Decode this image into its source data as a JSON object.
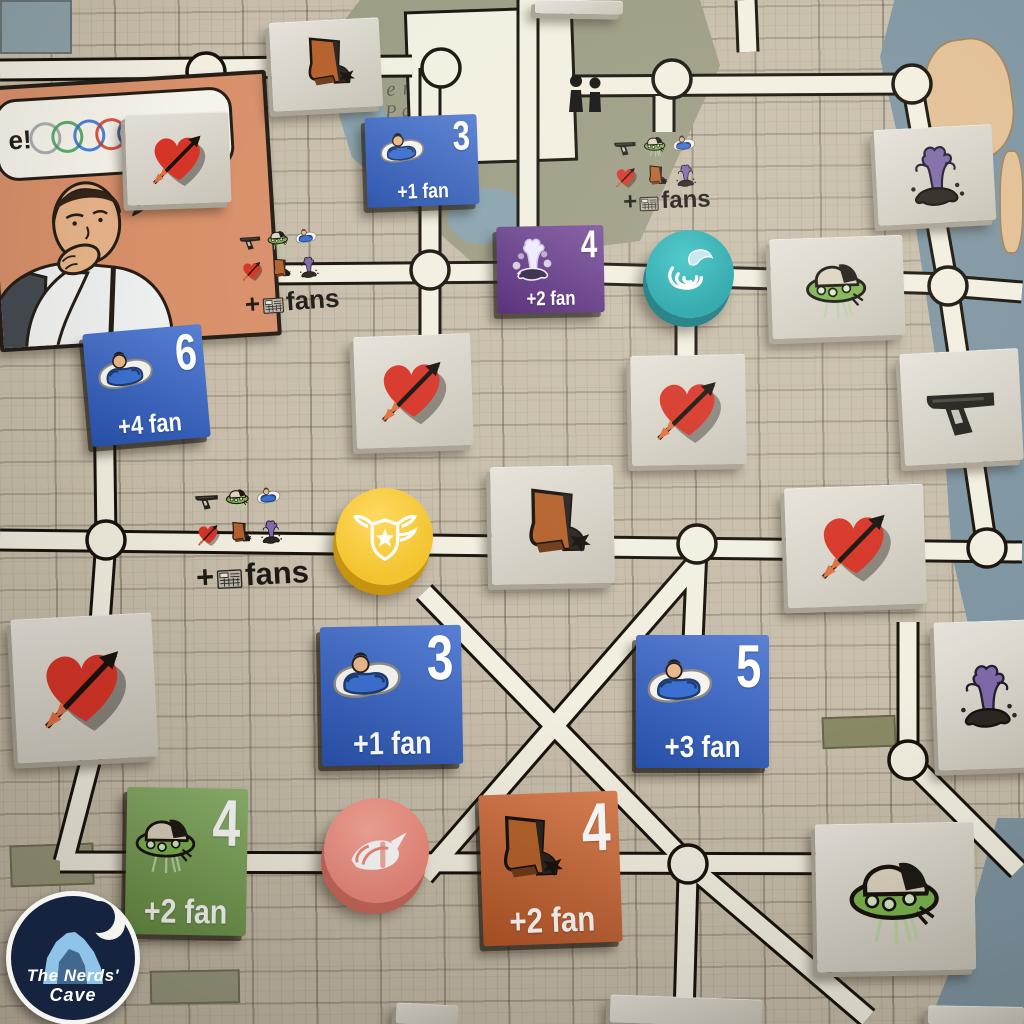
{
  "board": {
    "park_label_line1": "Central",
    "park_label_line2": "Park",
    "colors": {
      "paper": "#c7bdaa",
      "road": "#f2efe1",
      "road_outline": "#17130c",
      "park": "#9c9b83",
      "water": "#7e95a2",
      "sand": "#e2c096",
      "tile_gray": "#d9d5cb",
      "blue": "#2d5ec7",
      "purple": "#5b2a86",
      "green": "#74a44c",
      "orange": "#d2622c"
    }
  },
  "comic": {
    "bubble_text": "e!",
    "ring_colors": [
      "#9aa0a6",
      "#3f9e57",
      "#2e6fd0",
      "#d03a2a",
      "#274b9f"
    ]
  },
  "fans_tile": {
    "plus": "+",
    "label": "fans",
    "icons": [
      "gun",
      "ufo",
      "hero",
      "heart",
      "boot",
      "zombie"
    ]
  },
  "watermark": {
    "line1": "The Nerds'",
    "line2": "Cave"
  },
  "tiles": [
    {
      "id": "boot-tile-top-left",
      "kind": "icon",
      "icon": "boot",
      "x": 271,
      "y": 20,
      "w": 110,
      "h": 88,
      "rot": -3
    },
    {
      "id": "heart-tile-top-left",
      "kind": "icon",
      "icon": "heart",
      "x": 126,
      "y": 113,
      "w": 104,
      "h": 90,
      "rot": -2
    },
    {
      "id": "blue-reward-3-top",
      "kind": "reward",
      "icon": "hero",
      "color": "#2d5ec7",
      "number": "3",
      "fan": "+1 fan",
      "x": 366,
      "y": 116,
      "w": 112,
      "h": 90,
      "rot": -2
    },
    {
      "id": "fans-tile-top",
      "kind": "fans",
      "x": 606,
      "y": 127,
      "w": 120,
      "h": 92,
      "rot": -2
    },
    {
      "id": "zombie-tile-top-right",
      "kind": "icon",
      "icon": "zombie",
      "x": 876,
      "y": 127,
      "w": 118,
      "h": 95,
      "rot": -3
    },
    {
      "id": "fans-tile-upper-left",
      "kind": "fans",
      "x": 233,
      "y": 221,
      "w": 114,
      "h": 100,
      "rot": -4
    },
    {
      "id": "purple-reward-4",
      "kind": "reward",
      "icon": "zombieWhite",
      "color": "#5b2a86",
      "number": "4",
      "fan": "+2 fan",
      "x": 497,
      "y": 226,
      "w": 107,
      "h": 87,
      "rot": -1
    },
    {
      "id": "ufo-tile-right",
      "kind": "icon",
      "icon": "ufo",
      "x": 771,
      "y": 237,
      "w": 133,
      "h": 99,
      "rot": -2
    },
    {
      "id": "blue-reward-6",
      "kind": "reward",
      "icon": "hero",
      "color": "#2d5ec7",
      "number": "6",
      "fan": "+4 fan",
      "x": 87,
      "y": 329,
      "w": 119,
      "h": 113,
      "rot": -5
    },
    {
      "id": "heart-tile-mid-left",
      "kind": "icon",
      "icon": "heart",
      "x": 355,
      "y": 335,
      "w": 117,
      "h": 111,
      "rot": -2
    },
    {
      "id": "heart-tile-mid-right",
      "kind": "icon",
      "icon": "heart",
      "x": 631,
      "y": 355,
      "w": 115,
      "h": 109,
      "rot": -1
    },
    {
      "id": "gun-tile-right",
      "kind": "icon",
      "icon": "gun",
      "x": 902,
      "y": 351,
      "w": 119,
      "h": 111,
      "rot": -3
    },
    {
      "id": "fans-tile-mid",
      "kind": "fans",
      "x": 187,
      "y": 477,
      "w": 127,
      "h": 121,
      "rot": -3
    },
    {
      "id": "boot-tile-center",
      "kind": "icon",
      "icon": "boot",
      "x": 491,
      "y": 466,
      "w": 123,
      "h": 117,
      "rot": -1
    },
    {
      "id": "heart-tile-right",
      "kind": "icon",
      "icon": "heart",
      "x": 786,
      "y": 486,
      "w": 139,
      "h": 119,
      "rot": -2
    },
    {
      "id": "heart-tile-left",
      "kind": "icon",
      "icon": "heart",
      "x": 14,
      "y": 616,
      "w": 141,
      "h": 143,
      "rot": -3
    },
    {
      "id": "blue-reward-3-mid",
      "kind": "reward",
      "icon": "hero",
      "color": "#2d5ec7",
      "number": "3",
      "fan": "+1 fan",
      "x": 321,
      "y": 626,
      "w": 141,
      "h": 139,
      "rot": -1
    },
    {
      "id": "blue-reward-5",
      "kind": "reward",
      "icon": "hero",
      "color": "#2d5ec7",
      "number": "5",
      "fan": "+3 fan",
      "x": 636,
      "y": 635,
      "w": 133,
      "h": 133,
      "rot": 0
    },
    {
      "id": "zombie-tile-right",
      "kind": "icon",
      "icon": "zombie",
      "x": 936,
      "y": 621,
      "w": 100,
      "h": 147,
      "rot": -2
    },
    {
      "id": "green-reward-4",
      "kind": "reward",
      "icon": "ufo",
      "color": "#74a44c",
      "number": "4",
      "fan": "+2 fan",
      "x": 126,
      "y": 788,
      "w": 121,
      "h": 147,
      "rot": 1
    },
    {
      "id": "orange-reward-4",
      "kind": "reward",
      "icon": "boot",
      "color": "#d2622c",
      "number": "4",
      "fan": "+2 fan",
      "x": 481,
      "y": 793,
      "w": 139,
      "h": 151,
      "rot": -2
    },
    {
      "id": "ufo-tile-bottom-right",
      "kind": "icon",
      "icon": "ufo",
      "x": 816,
      "y": 823,
      "w": 159,
      "h": 147,
      "rot": -1
    },
    {
      "id": "tile-edge-top",
      "kind": "partial",
      "x": 535,
      "y": 0,
      "w": 88,
      "h": 13,
      "rot": 1
    },
    {
      "id": "tile-edge-bottom-left",
      "kind": "partial",
      "x": 396,
      "y": 1004,
      "w": 62,
      "h": 20,
      "rot": 3
    },
    {
      "id": "tile-edge-bottom-center",
      "kind": "partial",
      "x": 610,
      "y": 997,
      "w": 152,
      "h": 27,
      "rot": 2
    },
    {
      "id": "tile-edge-bottom-right",
      "kind": "partial",
      "x": 928,
      "y": 1006,
      "w": 96,
      "h": 18,
      "rot": 1
    }
  ],
  "tokens": [
    {
      "id": "teal-token",
      "icon": "tornado",
      "color": "#1fa3a9",
      "light": "#3dc3c6",
      "dark": "#13787f",
      "x": 646,
      "y": 230,
      "d": 88
    },
    {
      "id": "yellow-token",
      "icon": "badge",
      "color": "#f3c32c",
      "light": "#ffd95e",
      "dark": "#c79410",
      "x": 336,
      "y": 488,
      "d": 97
    },
    {
      "id": "salmon-token",
      "icon": "shell",
      "color": "#ee8a7d",
      "light": "#f8a99c",
      "dark": "#c9685c",
      "x": 324,
      "y": 798,
      "d": 105
    }
  ]
}
